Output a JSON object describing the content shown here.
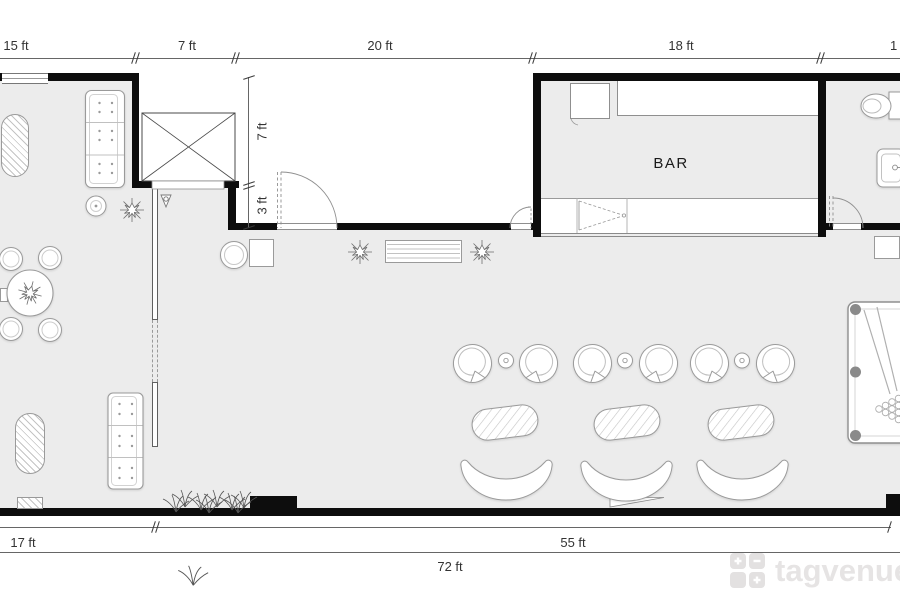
{
  "plan": {
    "bar_label": "BAR",
    "dims": {
      "top": [
        "15 ft",
        "7 ft",
        "20 ft",
        "18 ft",
        "1"
      ],
      "right": [
        "7 ft",
        "3 ft"
      ],
      "bottom": [
        "17 ft",
        "55 ft",
        "72 ft"
      ]
    }
  },
  "watermark": {
    "brand": "tagvenue"
  },
  "colors": {
    "wall": "#0d0d0d",
    "floor": "#ececec",
    "furniture_outline": "#9a9a9a",
    "dimension_text": "#333333",
    "watermark_gray": "#e5e3e3"
  }
}
